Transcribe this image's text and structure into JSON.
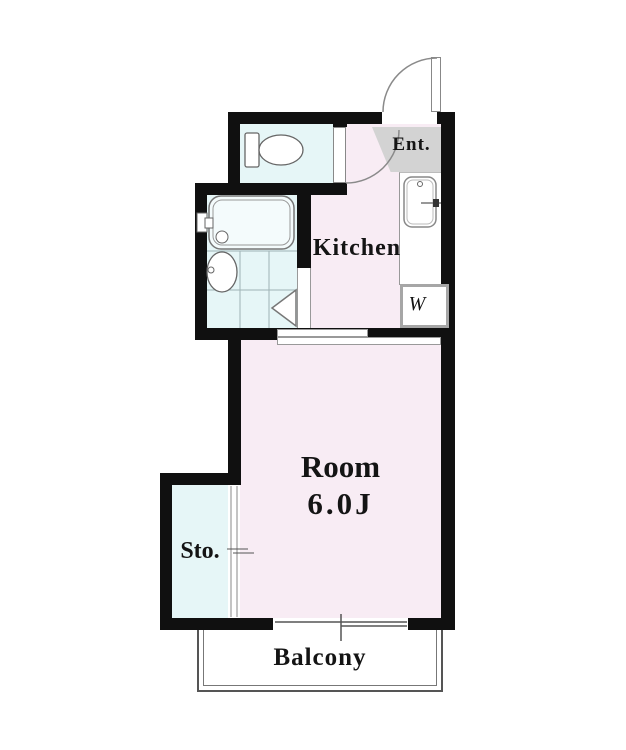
{
  "labels": {
    "entrance": "Ent.",
    "kitchen": "Kitchen",
    "room_name": "Room",
    "room_size": "6.0J",
    "storage": "Sto.",
    "balcony": "Balcony",
    "washer": "W"
  },
  "colors": {
    "wall": "#101010",
    "room_pink": "#f8ecf4",
    "wet_cyan": "#e6f6f7",
    "entry_gray": "#d3d3d3",
    "line": "#888888"
  }
}
